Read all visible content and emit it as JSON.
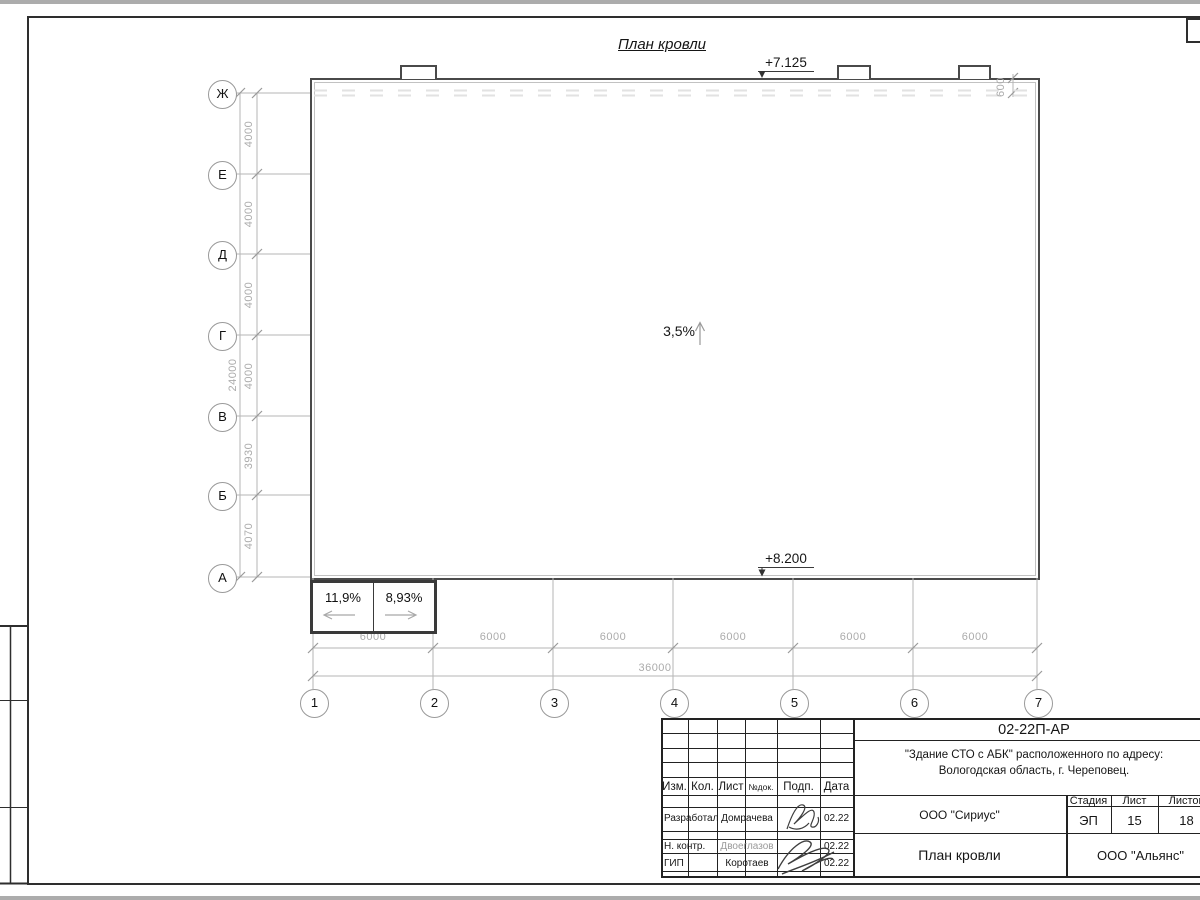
{
  "annotations": {
    "title": "План кровли",
    "elev_top": "+7.125",
    "elev_bottom": "+8.200",
    "slope_main": "3,5%",
    "slope_left": "11,9%",
    "slope_right": "8,93%"
  },
  "axes": {
    "row_labels": [
      "Ж",
      "Е",
      "Д",
      "Г",
      "В",
      "Б",
      "А"
    ],
    "row_dims": [
      "4000",
      "4000",
      "4000",
      "4000",
      "3930",
      "4070"
    ],
    "row_total": "24000",
    "col_labels": [
      "1",
      "2",
      "3",
      "4",
      "5",
      "6",
      "7"
    ],
    "col_dims": [
      "6000",
      "6000",
      "6000",
      "6000",
      "6000",
      "6000"
    ],
    "col_total": "36000",
    "edge_offset": "600"
  },
  "title_block": {
    "doc_number": "02-22П-АР",
    "object_line1": "\"Здание СТО с АБК\" расположенного по адресу:",
    "object_line2": "Вологодская область, г. Череповец.",
    "cols": [
      "Изм.",
      "Кол.",
      "Лист",
      "№док.",
      "Подп.",
      "Дата"
    ],
    "rows": [
      {
        "role": "Разработал",
        "name": "Домрачева",
        "date": "02.22"
      },
      {
        "role": "Н. контр.",
        "name": "Двоеглазов",
        "date": "02.22"
      },
      {
        "role": "ГИП",
        "name": "Коротаев",
        "date": "02.22"
      }
    ],
    "org": "ООО \"Сириус\"",
    "sheet_name": "План кровли",
    "firm": "ООО \"Альянс\"",
    "stage_label": "Стадия",
    "list_label": "Лист",
    "total_label": "Листов",
    "stage": "ЭП",
    "list": "15",
    "total": "18"
  }
}
